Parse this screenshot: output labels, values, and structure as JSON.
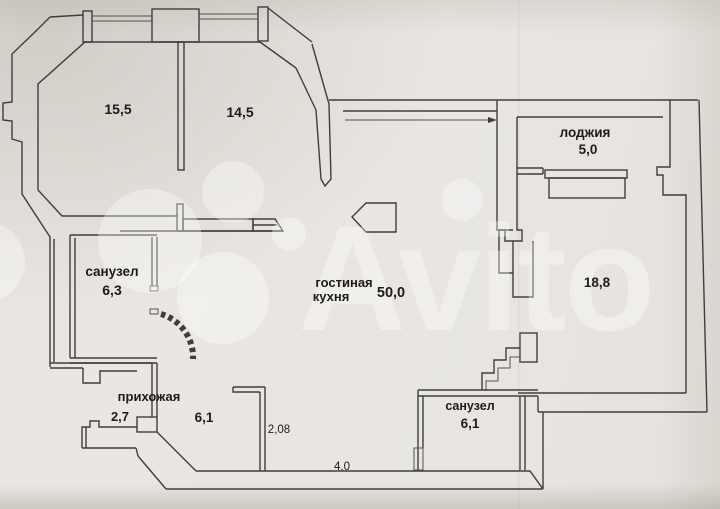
{
  "plan": {
    "watermark": "Avito",
    "rooms": {
      "r155": {
        "area": "15,5"
      },
      "r145": {
        "area": "14,5"
      },
      "loggia": {
        "name": "лоджия",
        "area": "5,0"
      },
      "bath_up": {
        "name": "санузел",
        "area": "6,3"
      },
      "living": {
        "name1": "гостиная",
        "name2": "кухня",
        "area": "50,0"
      },
      "r188": {
        "area": "18,8"
      },
      "hall": {
        "name": "прихожая",
        "area": "2,7"
      },
      "hall2": {
        "area": "6,1"
      },
      "bath_low": {
        "name": "санузел",
        "area": "6,1"
      }
    },
    "dims": {
      "d1": "2,08",
      "d2": "4,0"
    }
  }
}
